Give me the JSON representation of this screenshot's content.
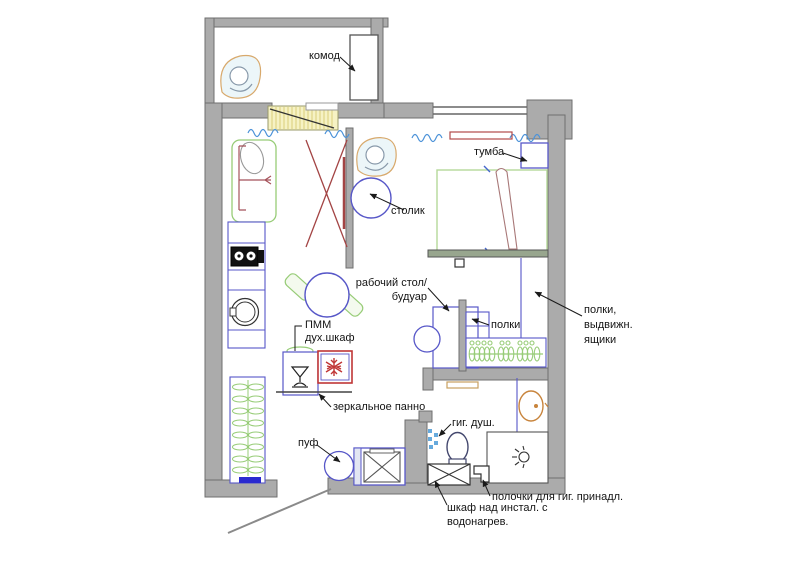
{
  "title": "apartment floor plan",
  "labels": {
    "komod": "комод",
    "tumba": "тумба",
    "stolik": "столик",
    "desk_line1": "рабочий стол/",
    "desk_line2": "будуар",
    "polki": "полки",
    "shelves_line1": "полки,",
    "shelves_line2": "выдвижн.",
    "shelves_line3": "ящики",
    "pmm_line1": "ПММ",
    "pmm_line2": "дух.шкаф",
    "mirror": "зеркальное панно",
    "puf": "пуф",
    "gig_dush": "гиг. душ.",
    "polochki": "полочки для гиг. принадл.",
    "shkaf_line1": "шкаф над инстал. с",
    "shkaf_line2": "водонагрев."
  },
  "colors": {
    "wall_fill": "#ababab",
    "wall_stroke": "#6f6f6f",
    "furniture_blue": "#5757c8",
    "furniture_green": "#97cc77",
    "bed_green": "#b5d89a",
    "accent_red": "#b24a4a",
    "fridge_red": "#c03636",
    "door_yellow": "#f6f2c4",
    "tan_orange": "#c8843c",
    "curtain_blue": "#4d93d9",
    "label_text": "#141414"
  }
}
